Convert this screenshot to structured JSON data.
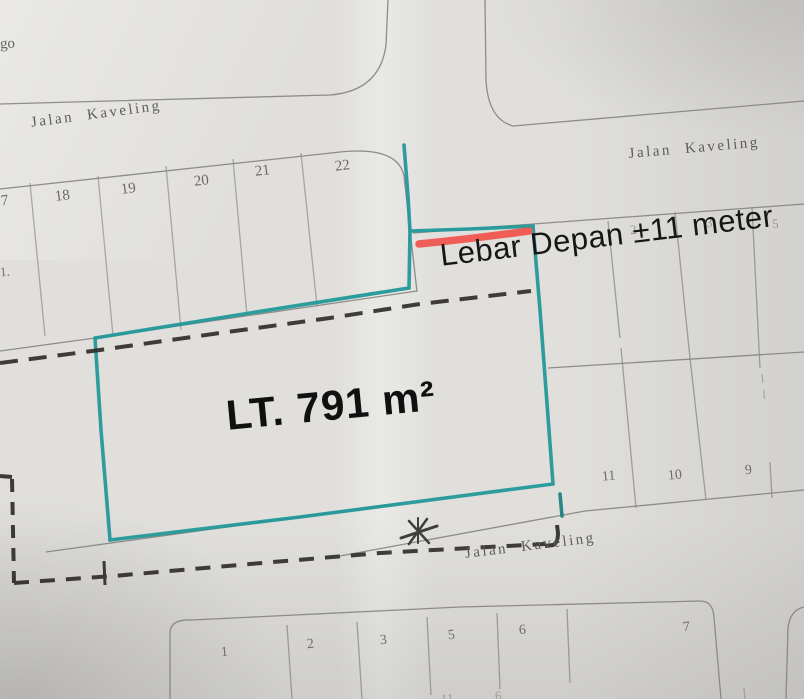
{
  "document": {
    "kind": "scanned land plot site plan (kaveling map)"
  },
  "streets": {
    "top_left": "Jalan Kaveling",
    "top_right": "Jalan Kaveling",
    "bottom": "Jalan Kaveling"
  },
  "annotations": {
    "front_width": "Lebar Depan ±11 meter",
    "area": "LT. 791 m²"
  },
  "plots": {
    "top_row": [
      "7",
      "18",
      "19",
      "20",
      "21",
      "22"
    ],
    "left_edge_partial": "1.",
    "top_left_partial": "go",
    "right_front_row": [
      "2",
      "3",
      "5"
    ],
    "right_back_row": [
      "11",
      "10",
      "9"
    ],
    "bottom_row": [
      "1",
      "2",
      "3",
      "5",
      "6",
      "7"
    ],
    "bottom_edge_partials": [
      "11",
      "6"
    ]
  },
  "colors": {
    "highlight_teal": "#23989a",
    "marker_red": "#f1504b",
    "dashed_ink": "#2b2a27",
    "print_gray": "#84837e",
    "paper": "#e0dfdb"
  }
}
